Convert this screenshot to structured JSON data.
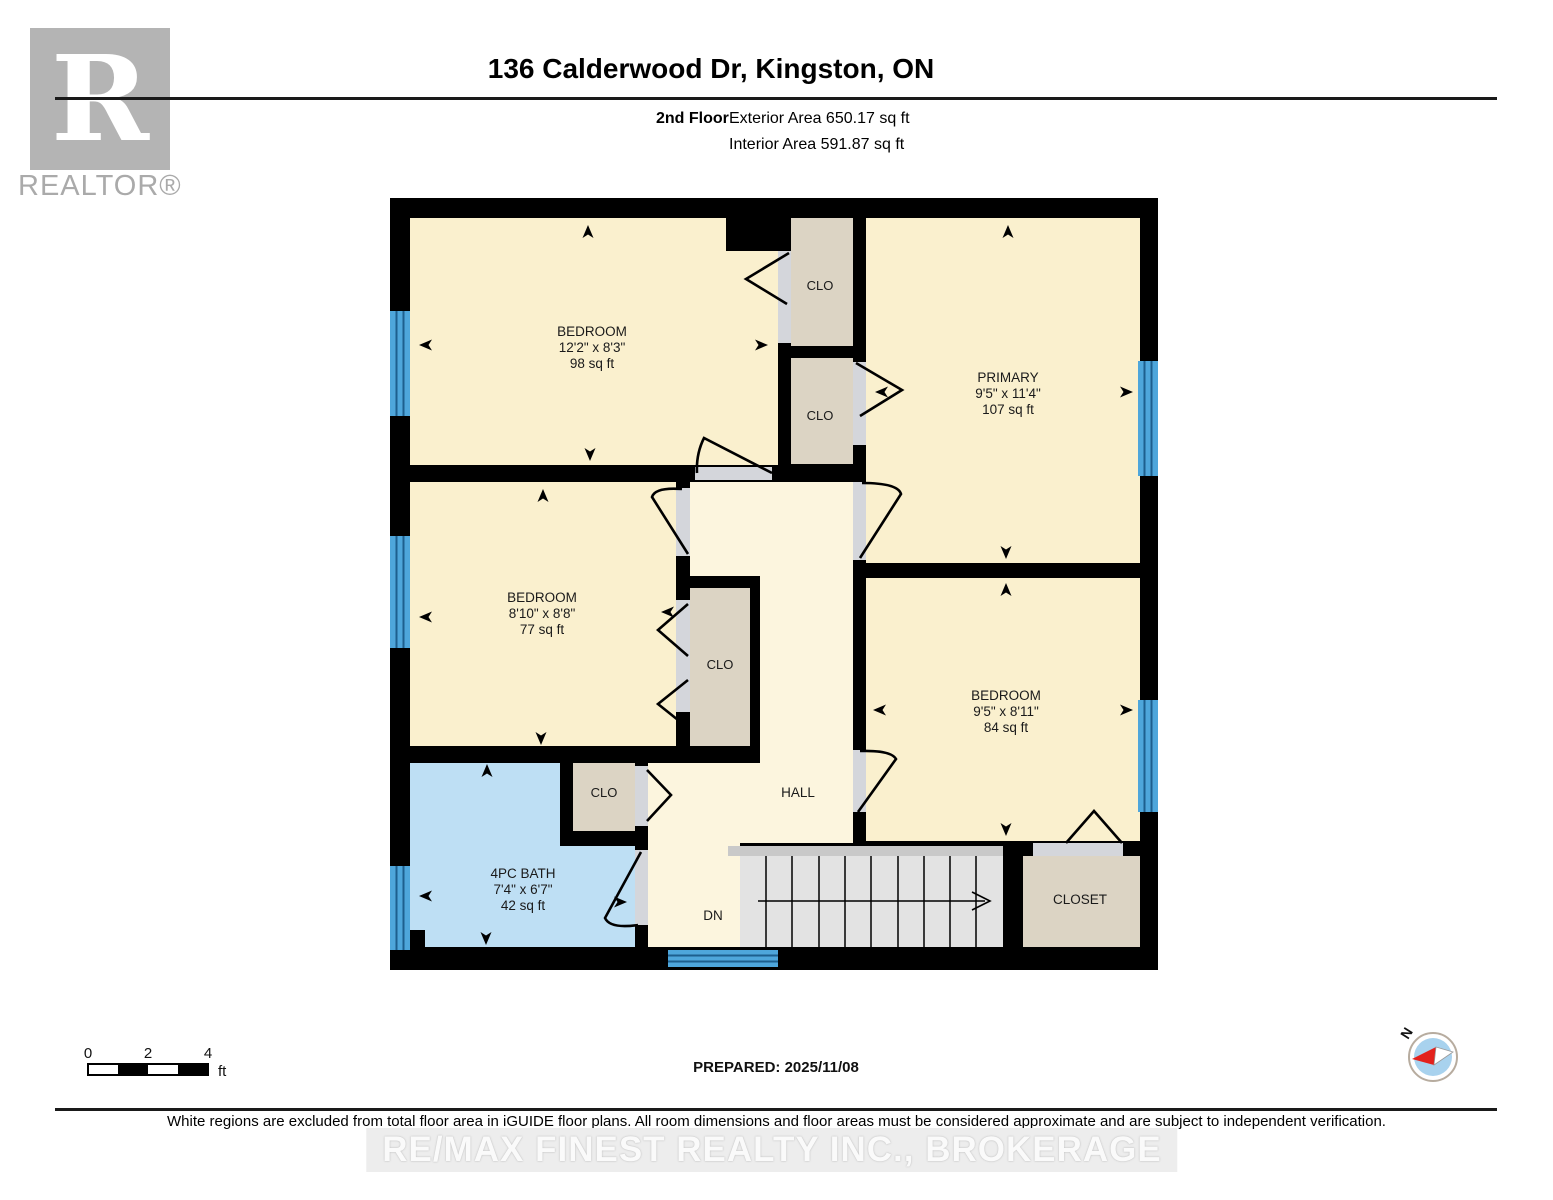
{
  "header": {
    "title": "136 Calderwood Dr, Kingston, ON",
    "floor_label": "2nd Floor",
    "exterior_area": "Exterior Area 650.17 sq ft",
    "interior_area": "Interior Area 591.87 sq ft"
  },
  "branding": {
    "logo_letter": "R",
    "logo_text": "REALTOR®",
    "watermark": "RE/MAX FINEST REALTY INC., BROKERAGE"
  },
  "floorplan": {
    "rooms": {
      "bedroom_tl": {
        "name": "BEDROOM",
        "dims": "12'2\" x 8'3\"",
        "area": "98 sq ft"
      },
      "primary": {
        "name": "PRIMARY",
        "dims": "9'5\" x 11'4\"",
        "area": "107 sq ft"
      },
      "bedroom_ml": {
        "name": "BEDROOM",
        "dims": "8'10\" x 8'8\"",
        "area": "77 sq ft"
      },
      "bedroom_r": {
        "name": "BEDROOM",
        "dims": "9'5\" x 8'11\"",
        "area": "84 sq ft"
      },
      "bath": {
        "name": "4PC BATH",
        "dims": "7'4\" x 6'7\"",
        "area": "42 sq ft"
      },
      "hall": {
        "label": "HALL"
      },
      "stairs": {
        "label": "DN"
      },
      "closet_top": {
        "label": "CLO"
      },
      "closet_mid": {
        "label": "CLO"
      },
      "closet_hall": {
        "label": "CLO"
      },
      "closet_small": {
        "label": "CLO"
      },
      "closet_main": {
        "label": "CLOSET"
      }
    },
    "colors": {
      "wall": "#000000",
      "room_fill": "#FAF0CE",
      "hall_fill": "#FCF5DE",
      "closet_fill": "#DCD4C4",
      "bath_fill": "#BEDFF4",
      "window": "#4EA6DB",
      "door_opening": "#D4D6DB",
      "stairs_fill": "#E3E3E3"
    }
  },
  "footer": {
    "scale_bar": {
      "ticks": [
        "0",
        "2",
        "4"
      ],
      "unit": "ft"
    },
    "prepared": "PREPARED: 2025/11/08",
    "compass_label": "N",
    "disclaimer": "White regions are excluded from total floor area in iGUIDE floor plans. All room dimensions and floor areas must be considered approximate and are subject to independent verification."
  }
}
